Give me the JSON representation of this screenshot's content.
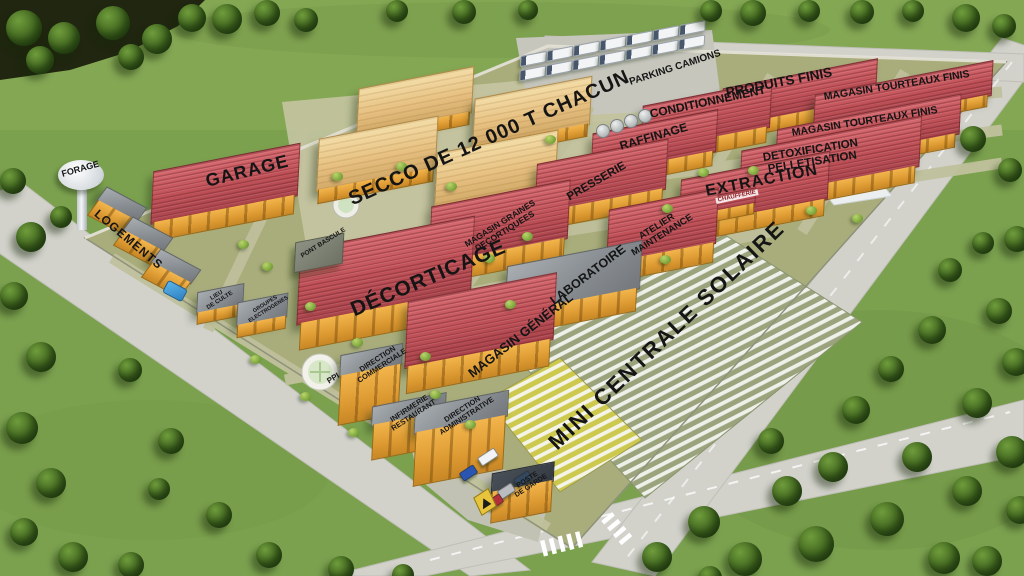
{
  "labels": {
    "forage": "FORAGE",
    "logements": "LOGEMENTS",
    "garage": "GARAGE",
    "secco": "SECCO DE 12 000 T CHACUN",
    "parking_camions": "PARKING CAMIONS",
    "produits_finis": "PRODUITS FINIS",
    "conditionnement": "CONDITIONNEMENT",
    "magasin_tourteaux_finis_1": "MAGASIN TOURTEAUX FINIS",
    "magasin_tourteaux_finis_2": "MAGASIN TOURTEAUX FINIS",
    "raffinage": "RAFFINAGE",
    "detoxification_pelletisation": "DETOXIFICATION\nPELLETISATION",
    "presserie": "PRESSERIE",
    "extraction": "EXTRACTION",
    "chaufferie": "CHAUFFERIE",
    "magasin_graines_decortiquees": "MAGASIN GRAINES\nDECORTIQUEES",
    "atelier_maintenance": "ATELIER\nMAINTENANCE",
    "decorticage": "DÉCORTICAGE",
    "laboratoire": "LABORATOIRE",
    "magasin_general": "MAGASIN GÉNÉRAL",
    "mini_centrale_solaire": "MINI CENTRALE SOLAIRE",
    "pont_bascule": "PONT BASCULE",
    "lieu_de_culte": "LIEU\nDE CULTE",
    "groupes_electrogenes": "GROUPES\nELECTROGENES",
    "ppi": "PPI",
    "direction_commerciale": "DIRECTION\nCOMMERCIALE",
    "infirmerie_restaurant": "INFIRMERIE\nRESTAURANT",
    "direction_administrative": "DIRECTION\nADMINISTRATIVE",
    "poste_de_garde": "POSTE\nDE GARDE"
  },
  "colors": {
    "grass": "#7ba14f",
    "compound_ground": "#a9ad7b",
    "road": "#d2d2cb",
    "roof_red": "#c05158",
    "wall_yellow": "#e5a33e",
    "shed_tan": "#e7c182",
    "solar_panel": "#eef0ea",
    "label_text": "#151515"
  }
}
